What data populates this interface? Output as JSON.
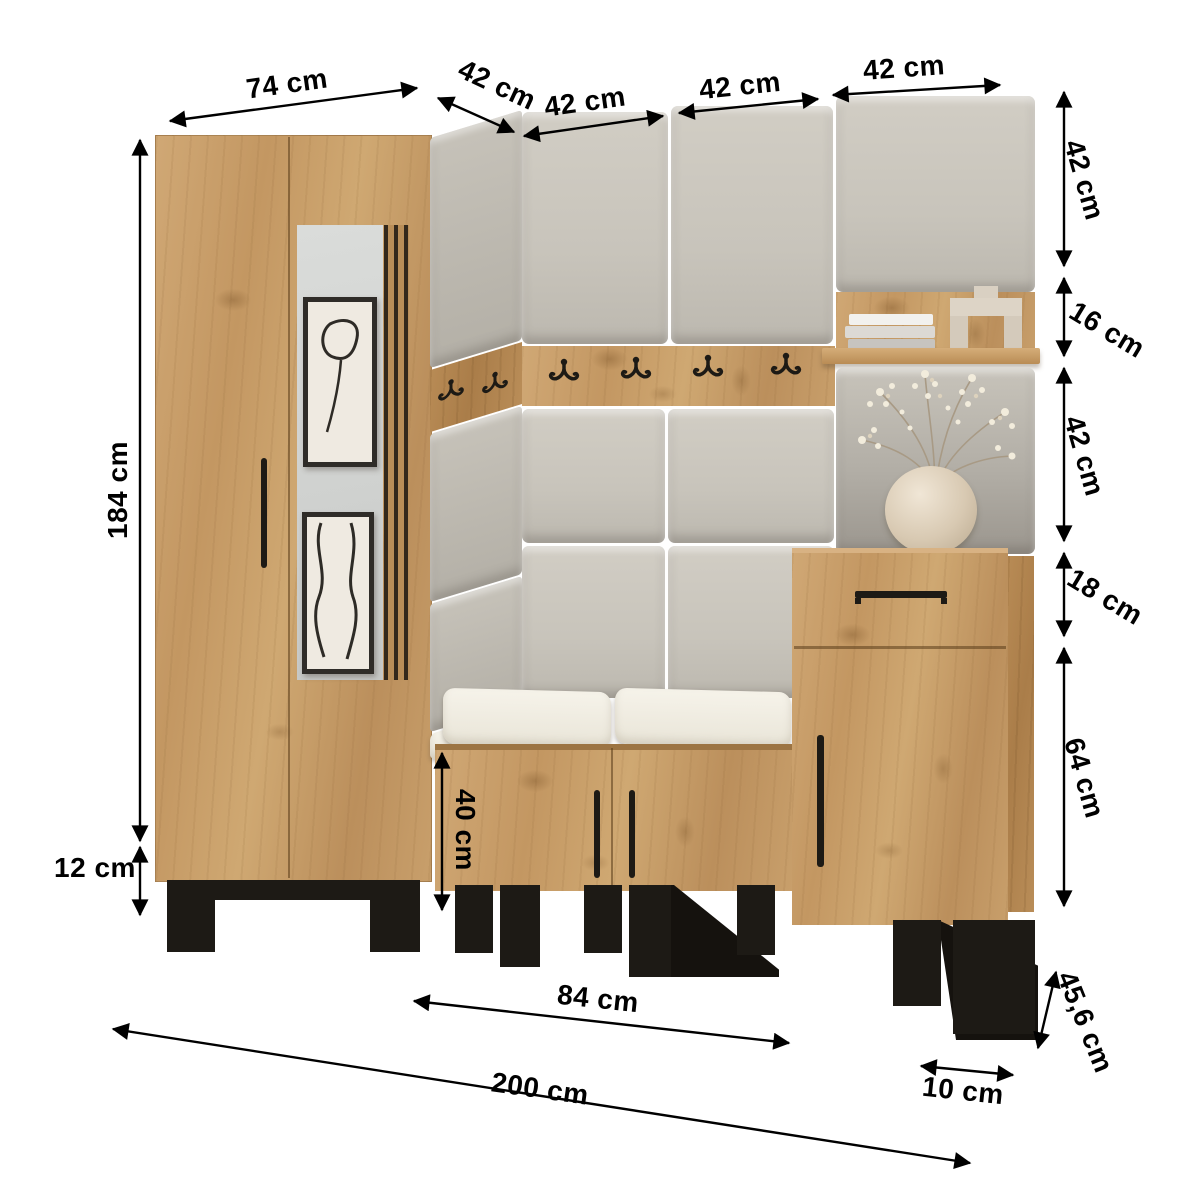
{
  "diagram": {
    "type": "furniture-dimension-diagram",
    "subject": "hallway entryway furniture set with wardrobe, mirror, upholstered wall panels, coat hook rail, shelf, bench and cabinet",
    "unit": "cm"
  },
  "dims": {
    "wardrobe_width": "74 cm",
    "corner_panel_width": "42 cm",
    "panel_width_a": "42 cm",
    "panel_width_b": "42 cm",
    "panel_width_c": "42 cm",
    "top_panel_height": "42 cm",
    "hook_shelf_band_height": "16 cm",
    "mid_panel_height": "42 cm",
    "drawer_height": "18 cm",
    "cabinet_door_height": "64 cm",
    "wardrobe_height": "184 cm",
    "leg_height": "12 cm",
    "bench_cabinet_height": "40 cm",
    "bench_width": "84 cm",
    "total_width": "200 cm",
    "foot_width": "10 cm",
    "total_depth": "45,6 cm"
  },
  "colors": {
    "dimension_lines": "#000000",
    "wood_light": "#cfa872",
    "wood_dark": "#aa7d49",
    "upholstery": "#c8c4bb",
    "upholstery_shadow": "#9b968e",
    "cushion": "#f3f0e7",
    "metal_black": "#1d1a15",
    "mirror": "#d5d7d5",
    "art_paper": "#efeae1",
    "vase": "#e0d3bf",
    "flowers": "#f2ecdc"
  }
}
